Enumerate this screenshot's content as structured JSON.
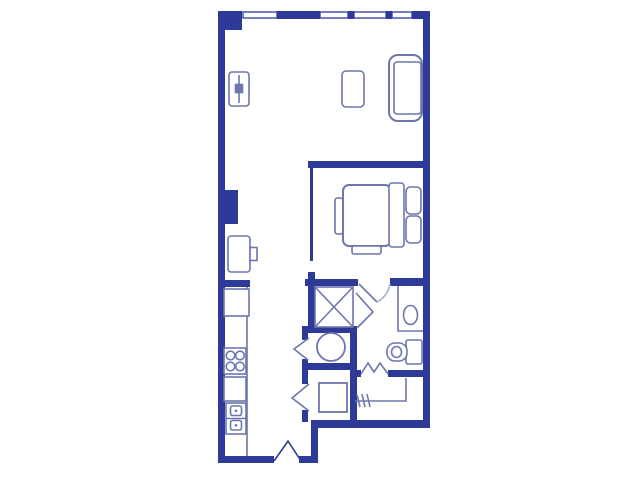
{
  "palette": {
    "wall": "#2e3a97",
    "furniture": "#6d76ad",
    "light": "#aab0d2",
    "background": "#ffffff"
  },
  "floorplan": {
    "walls": [
      {
        "name": "top-left-corner-column",
        "x": 218,
        "y": 11,
        "w": 24,
        "h": 19
      },
      {
        "name": "top-wall-segment-a",
        "x": 277,
        "y": 11,
        "w": 43,
        "h": 8
      },
      {
        "name": "top-wall-mullion-1",
        "x": 348,
        "y": 11,
        "w": 6,
        "h": 8
      },
      {
        "name": "top-wall-mullion-2",
        "x": 386,
        "y": 11,
        "w": 6,
        "h": 8
      },
      {
        "name": "top-wall-segment-b",
        "x": 412,
        "y": 11,
        "w": 12,
        "h": 8
      },
      {
        "name": "right-exterior-wall",
        "x": 423,
        "y": 11,
        "w": 7,
        "h": 417
      },
      {
        "name": "left-exterior-wall",
        "x": 218,
        "y": 11,
        "w": 7,
        "h": 452
      },
      {
        "name": "left-wall-column",
        "x": 218,
        "y": 190,
        "w": 20,
        "h": 34
      },
      {
        "name": "kitchen-wall-stub",
        "x": 218,
        "y": 280,
        "w": 32,
        "h": 7
      },
      {
        "name": "bottom-wall-left",
        "x": 218,
        "y": 456,
        "w": 56,
        "h": 7
      },
      {
        "name": "bottom-wall-entry-right",
        "x": 299,
        "y": 456,
        "w": 19,
        "h": 7
      },
      {
        "name": "entry-right-vertical-wall",
        "x": 311,
        "y": 421,
        "w": 7,
        "h": 42
      },
      {
        "name": "bottom-wall-right-section",
        "x": 311,
        "y": 420,
        "w": 119,
        "h": 8
      },
      {
        "name": "bedroom-divider-wall",
        "x": 308,
        "y": 161,
        "w": 122,
        "h": 7
      },
      {
        "name": "bedroom-left-wall",
        "x": 310,
        "y": 168,
        "w": 3,
        "h": 93
      },
      {
        "name": "bathroom-top-wall-left",
        "x": 305,
        "y": 279,
        "w": 53,
        "h": 7
      },
      {
        "name": "bathroom-top-wall-right",
        "x": 390,
        "y": 278,
        "w": 33,
        "h": 8
      },
      {
        "name": "bathroom-corner-stub",
        "x": 308,
        "y": 272,
        "w": 7,
        "h": 14
      },
      {
        "name": "shower-left-wall",
        "x": 308,
        "y": 286,
        "w": 7,
        "h": 47
      },
      {
        "name": "laundry-top-wall",
        "x": 302,
        "y": 326,
        "w": 55,
        "h": 7
      },
      {
        "name": "laundry-right-wall",
        "x": 350,
        "y": 326,
        "w": 7,
        "h": 98
      },
      {
        "name": "laundry-mid-wall",
        "x": 302,
        "y": 363,
        "w": 48,
        "h": 7
      },
      {
        "name": "hall-wall-stub-a",
        "x": 302,
        "y": 333,
        "w": 6,
        "h": 7
      },
      {
        "name": "hall-wall-stub-b",
        "x": 302,
        "y": 359,
        "w": 6,
        "h": 25
      },
      {
        "name": "hall-wall-stub-c",
        "x": 302,
        "y": 410,
        "w": 6,
        "h": 12
      },
      {
        "name": "closet-divider-wall-left",
        "x": 355,
        "y": 370,
        "w": 6,
        "h": 7
      },
      {
        "name": "closet-divider-wall-right",
        "x": 388,
        "y": 370,
        "w": 35,
        "h": 7
      }
    ],
    "windows": [
      {
        "name": "window-1",
        "x": 243,
        "y": 12,
        "w": 34,
        "h": 6
      },
      {
        "name": "window-2",
        "x": 320,
        "y": 12,
        "w": 28,
        "h": 6
      },
      {
        "name": "window-3",
        "x": 354,
        "y": 12,
        "w": 32,
        "h": 6
      },
      {
        "name": "window-4",
        "x": 392,
        "y": 12,
        "w": 20,
        "h": 6
      }
    ],
    "shapes": [
      {
        "name": "radiator",
        "type": "rrect",
        "role": "furniture",
        "x": 229,
        "y": 72,
        "w": 20,
        "h": 34,
        "r": 3
      },
      {
        "name": "radiator-line",
        "type": "line",
        "role": "furniture",
        "x1": 239,
        "y1": 75,
        "x2": 239,
        "y2": 103
      },
      {
        "name": "radiator-knob",
        "type": "rect",
        "role": "furniture",
        "x": 235.5,
        "y": 84.5,
        "w": 7,
        "h": 8,
        "fill": "furniture"
      },
      {
        "name": "tv-console",
        "type": "rrect",
        "role": "furniture",
        "x": 228,
        "y": 236,
        "w": 22,
        "h": 36,
        "r": 3
      },
      {
        "name": "tv-console-knob",
        "type": "rect",
        "role": "furniture",
        "x": 250,
        "y": 247.5,
        "w": 7,
        "h": 13
      },
      {
        "name": "side-table",
        "type": "rrect",
        "role": "furniture",
        "x": 342,
        "y": 71,
        "w": 22,
        "h": 36,
        "r": 4
      },
      {
        "name": "sofa-outer",
        "type": "rrect",
        "role": "furniture",
        "x": 389,
        "y": 55,
        "w": 33,
        "h": 66,
        "r": 9,
        "sw": 2
      },
      {
        "name": "sofa-seat",
        "type": "rrect",
        "role": "furniture",
        "x": 394,
        "y": 62,
        "w": 27,
        "h": 52,
        "r": 3
      },
      {
        "name": "bed-footboard",
        "type": "rrect",
        "role": "furniture",
        "x": 335,
        "y": 198,
        "w": 8,
        "h": 36,
        "r": 2.5
      },
      {
        "name": "bed-mattress",
        "type": "rrect",
        "role": "furniture",
        "x": 343,
        "y": 185,
        "w": 48,
        "h": 61,
        "r": 6,
        "sw": 2
      },
      {
        "name": "bed-duvet-fold",
        "type": "rrect",
        "role": "furniture",
        "x": 389,
        "y": 183,
        "w": 15,
        "h": 64,
        "r": 3
      },
      {
        "name": "bed-pillow-1",
        "type": "rrect",
        "role": "furniture",
        "x": 406,
        "y": 187,
        "w": 15,
        "h": 27,
        "r": 4.5
      },
      {
        "name": "bed-pillow-2",
        "type": "rrect",
        "role": "furniture",
        "x": 406,
        "y": 216,
        "w": 15,
        "h": 27,
        "r": 4.5
      },
      {
        "name": "bed-bench",
        "type": "rrect",
        "role": "furniture",
        "x": 352,
        "y": 246,
        "w": 29,
        "h": 8,
        "r": 2
      },
      {
        "name": "kitchen-counter-edge",
        "type": "line",
        "role": "furniture",
        "x1": 247,
        "y1": 287,
        "x2": 247,
        "y2": 456
      },
      {
        "name": "kitchen-sink",
        "type": "rect",
        "role": "furniture",
        "x": 224,
        "y": 289,
        "w": 25,
        "h": 27
      },
      {
        "name": "stove",
        "type": "rect",
        "role": "furniture",
        "x": 224,
        "y": 348,
        "w": 22,
        "h": 26
      },
      {
        "name": "burner-1",
        "type": "circle",
        "role": "furniture",
        "cx": 230.5,
        "cy": 355.5,
        "r": 4.3
      },
      {
        "name": "burner-2",
        "type": "circle",
        "role": "furniture",
        "cx": 240,
        "cy": 355.5,
        "r": 4.3
      },
      {
        "name": "burner-3",
        "type": "circle",
        "role": "furniture",
        "cx": 230.5,
        "cy": 366.5,
        "r": 4.3
      },
      {
        "name": "burner-4",
        "type": "circle",
        "role": "furniture",
        "cx": 240,
        "cy": 366.5,
        "r": 4.3
      },
      {
        "name": "oven",
        "type": "rect",
        "role": "furniture",
        "x": 224,
        "y": 377,
        "w": 22,
        "h": 24
      },
      {
        "name": "refrigerator",
        "type": "rect",
        "role": "furniture",
        "x": 226,
        "y": 403,
        "w": 20,
        "h": 31
      },
      {
        "name": "refrigerator-divider",
        "type": "line",
        "role": "furniture",
        "x1": 226,
        "y1": 418.5,
        "x2": 246,
        "y2": 418.5
      },
      {
        "name": "refrigerator-drawer-1",
        "type": "rrect",
        "role": "furniture",
        "x": 230.5,
        "y": 406,
        "w": 11,
        "h": 9.5,
        "r": 2
      },
      {
        "name": "refrigerator-drawer-2",
        "type": "rrect",
        "role": "furniture",
        "x": 230.5,
        "y": 420.5,
        "w": 11,
        "h": 9.5,
        "r": 2
      },
      {
        "name": "drawer-dot-1",
        "type": "dot",
        "role": "furniture",
        "cx": 236,
        "cy": 410.8,
        "r": 1.3
      },
      {
        "name": "drawer-dot-2",
        "type": "dot",
        "role": "furniture",
        "cx": 236,
        "cy": 425.3,
        "r": 1.3
      },
      {
        "name": "shower-stall",
        "type": "rect",
        "role": "furniture",
        "x": 315,
        "y": 287,
        "w": 38,
        "h": 40
      },
      {
        "name": "shower-diagonal-1",
        "type": "line",
        "role": "furniture",
        "x1": 315,
        "y1": 287,
        "x2": 353,
        "y2": 327
      },
      {
        "name": "shower-diagonal-2",
        "type": "line",
        "role": "furniture",
        "x1": 353,
        "y1": 287,
        "x2": 315,
        "y2": 327
      },
      {
        "name": "vanity-counter",
        "type": "polyline",
        "role": "furniture",
        "pts": "398,286 398,331 423,331"
      },
      {
        "name": "vanity-sink",
        "type": "ellipse",
        "role": "furniture",
        "cx": 410.5,
        "cy": 315,
        "rx": 7,
        "ry": 9.5
      },
      {
        "name": "toilet-tank",
        "type": "rrect",
        "role": "furniture",
        "x": 406,
        "y": 340,
        "w": 16,
        "h": 24,
        "r": 2
      },
      {
        "name": "toilet-bowl",
        "type": "rrect",
        "role": "furniture",
        "x": 387,
        "y": 343,
        "w": 20,
        "h": 18,
        "r": 8
      },
      {
        "name": "toilet-bowl-inner",
        "type": "ellipse",
        "role": "furniture",
        "cx": 396.5,
        "cy": 352,
        "rx": 5,
        "ry": 5.5
      },
      {
        "name": "washer",
        "type": "circle",
        "role": "furniture",
        "cx": 331,
        "cy": 347,
        "r": 14,
        "sw": 1.8
      },
      {
        "name": "utility-unit",
        "type": "rect",
        "role": "furniture",
        "x": 319,
        "y": 383,
        "w": 28,
        "h": 29,
        "sw": 1.8
      },
      {
        "name": "closet-rod",
        "type": "polyline",
        "role": "furniture",
        "pts": "355,401 406,401 406,378"
      },
      {
        "name": "hanger-tick-1",
        "type": "line",
        "role": "furniture",
        "x1": 357,
        "y1": 395,
        "x2": 360,
        "y2": 407
      },
      {
        "name": "hanger-tick-2",
        "type": "line",
        "role": "furniture",
        "x1": 362,
        "y1": 394,
        "x2": 365,
        "y2": 407
      },
      {
        "name": "hanger-tick-3",
        "type": "line",
        "role": "furniture",
        "x1": 367,
        "y1": 394,
        "x2": 370,
        "y2": 407
      },
      {
        "name": "bathroom-door-leaf",
        "type": "line",
        "role": "furniture",
        "x1": 359,
        "y1": 284,
        "x2": 377,
        "y2": 302
      },
      {
        "name": "bathroom-door-arc",
        "type": "path",
        "role": "light",
        "d": "M377,302 Q388,296 390,284"
      },
      {
        "name": "shower-door",
        "type": "polyline",
        "role": "furniture",
        "pts": "356,293 373,312 357,328"
      },
      {
        "name": "laundry-door",
        "type": "polyline",
        "role": "furniture",
        "pts": "309,338 294,349 308,360"
      },
      {
        "name": "utility-door",
        "type": "polyline",
        "role": "furniture",
        "pts": "309,384 292,398 309,411"
      },
      {
        "name": "entry-door",
        "type": "polyline",
        "role": "wallline",
        "pts": "274,461 288,441 301,461"
      },
      {
        "name": "closet-bifold-door",
        "type": "polyline",
        "role": "furniture",
        "pts": "361,374 368,363 374,372 380,363 388,374"
      }
    ]
  }
}
